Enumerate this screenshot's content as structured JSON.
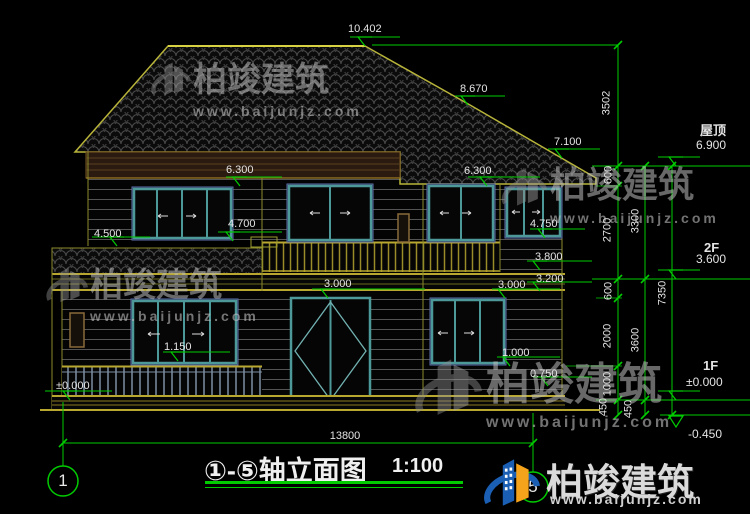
{
  "title_block": {
    "title": "①-⑤轴立面图",
    "scale": "1:100"
  },
  "axes": {
    "start": "1",
    "end": "5"
  },
  "dimensions": {
    "overall_width": "13800",
    "right_inner": [
      "3502",
      "600",
      "2700",
      "600",
      "2000",
      "1000",
      "450"
    ],
    "right_middle": [
      "3300",
      "3600",
      "450"
    ],
    "right_outer": "7350"
  },
  "levels": {
    "roof_label": "屋顶",
    "roof_elev": "6.900",
    "f2_label": "2F",
    "f2_elev": "3.600",
    "f1_label": "1F",
    "f1_elev": "±0.000",
    "ground_elev": "-0.450"
  },
  "elevation_marks": {
    "ridge": "10.402",
    "slope": "8.670",
    "wing_eave": "7.100",
    "win2f_left_top": "6.300",
    "win2f_right_top": "6.300",
    "ledge_left": "4.500",
    "balcony_floor": "4.700",
    "win2f_right_sill": "4.750",
    "railing_top": "3.800",
    "slab_bottom": "3.200",
    "door_top": "3.000",
    "win1f_right_top": "3.000",
    "win1f_left_sill": "1.150",
    "win1f_right_sill": "1.000",
    "porch_floor": "0.750",
    "ground_zero": "±0.000"
  },
  "watermark": {
    "brand": "柏竣建筑",
    "site": "www.baijunjz.com"
  },
  "colors": {
    "annotation_green": "#00cc00",
    "roof_outline": "#b8b43a",
    "window_teal": "#4d9999",
    "logo_blue": "#1a5fb4",
    "logo_orange": "#f5a31a"
  }
}
